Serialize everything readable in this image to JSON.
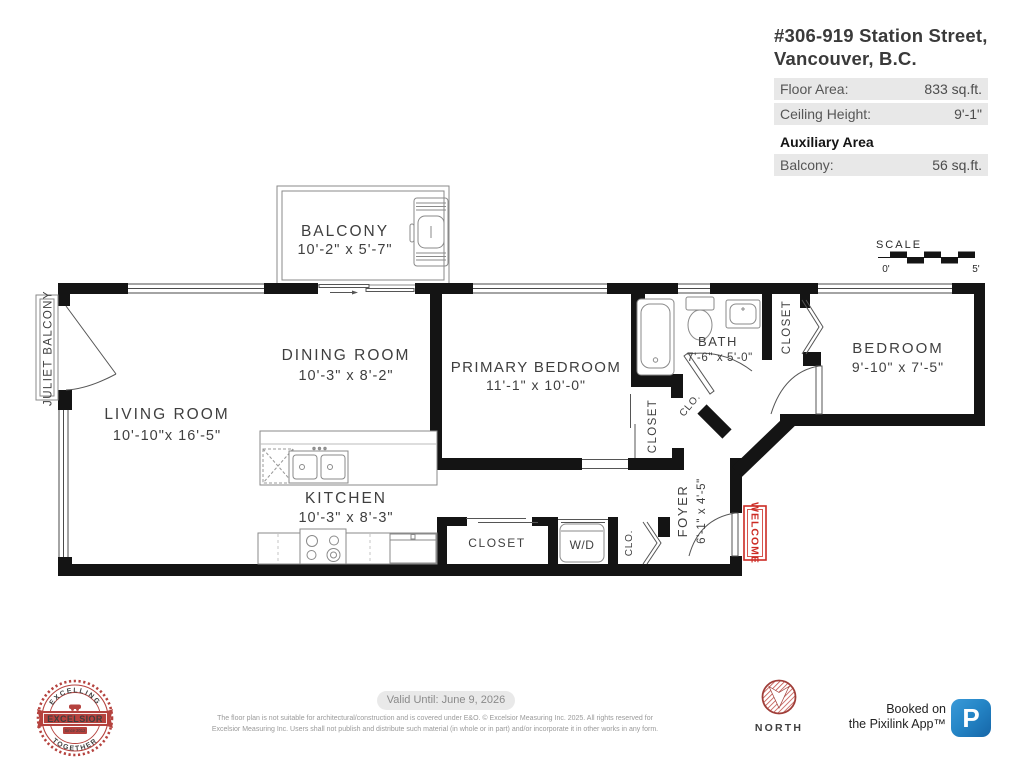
{
  "header": {
    "address_line1": "#306-919 Station Street,",
    "address_line2": "Vancouver, B.C.",
    "rows": [
      {
        "label": "Floor Area:",
        "value": "833 sq.ft."
      },
      {
        "label": "Ceiling Height:",
        "value": "9'-1\""
      }
    ],
    "auxiliary_title": "Auxiliary Area",
    "aux_row": {
      "label": "Balcony:",
      "value": "56 sq.ft."
    }
  },
  "scale": {
    "title": "SCALE",
    "zero": "0'",
    "five": "5'"
  },
  "rooms": {
    "balcony": {
      "name": "BALCONY",
      "dims": "10'-2\" x 5'-7\""
    },
    "juliet": {
      "name": "JULIET BALCONY"
    },
    "living": {
      "name": "LIVING ROOM",
      "dims": "10'-10\"x 16'-5\""
    },
    "dining": {
      "name": "DINING ROOM",
      "dims": "10'-3\" x 8'-2\""
    },
    "kitchen": {
      "name": "KITCHEN",
      "dims": "10'-3\" x 8'-3\""
    },
    "primary": {
      "name": "PRIMARY BEDROOM",
      "dims": "11'-1\" x 10'-0\""
    },
    "bath": {
      "name": "BATH",
      "dims": "7'-6\" x 5'-0\""
    },
    "bedroom": {
      "name": "BEDROOM",
      "dims": "9'-10\" x 7'-5\""
    },
    "foyer": {
      "name": "FOYER",
      "dims": "6'-1\" x 4'-5\""
    },
    "closet_bath": {
      "name": "CLOSET"
    },
    "closet_primary": {
      "name": "CLOSET"
    },
    "closet_hall": {
      "name": "CLOSET"
    },
    "clo_bath": {
      "name": "CLO."
    },
    "clo_entry": {
      "name": "CLO."
    },
    "wd": {
      "name": "W/D"
    },
    "welcome": {
      "name": "WELCOME"
    }
  },
  "footer": {
    "valid_until": "Valid Until: June 9, 2026",
    "disclaimer_line1": "The floor plan is not suitable for architectural/construction and is covered under E&O. © Excelsior Measuring Inc. 2025. All rights reserved for",
    "disclaimer_line2": "Excelsior Measuring Inc. Users shall not publish and distribute such material (in whole or in part) and/or incorporate it in other works in any form.",
    "north_label": "NORTH",
    "booked_line1": "Booked on",
    "booked_line2": "the Pixilink App™",
    "pixilink_letter": "P",
    "logo": {
      "top": "EXCELLING",
      "center": "EXCELSIOR",
      "bottom": "TOGETHER",
      "since": "Since 2012"
    }
  },
  "colors": {
    "wall": "#141414",
    "accent_red": "#b5423e",
    "welcome_red": "#cc2b24",
    "pixilink_blue": "#2586c7",
    "row_bg": "#e8e8e8"
  }
}
